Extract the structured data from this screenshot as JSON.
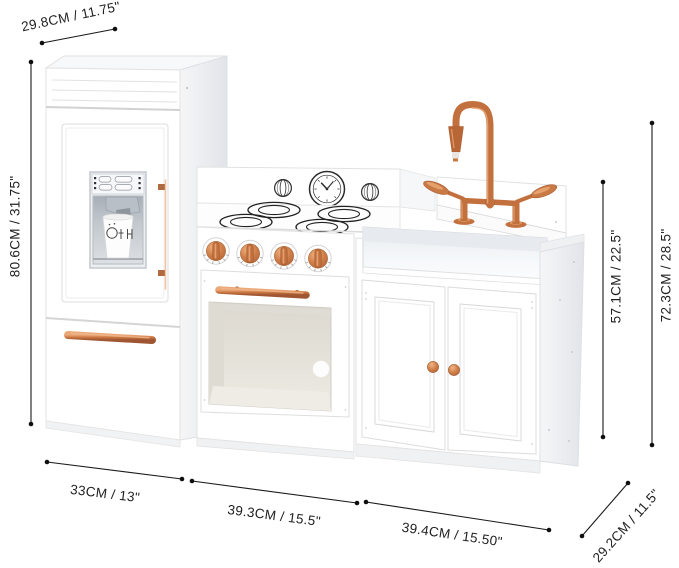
{
  "meta": {
    "description": "Play kitchen product dimension diagram",
    "background": "#ffffff"
  },
  "theme": {
    "copper": "#c9764a",
    "copper-dark": "#a85a32",
    "line-color": "#1a1a1a",
    "text-color": "#1f1f1f",
    "bg": "#ffffff"
  },
  "labels": {
    "top_depth": "29.8CM / 11.75\"",
    "left_height": "80.6CM / 31.75\"",
    "counter_height": "57.1CM / 22.5\"",
    "total_height": "72.3CM / 28.5\"",
    "bottom_left_width": "33CM / 13\"",
    "bottom_middle_width": "39.3CM / 15.5\"",
    "bottom_right_width": "39.4CM / 15.50\"",
    "right_depth": "29.2CM / 11.5\""
  }
}
